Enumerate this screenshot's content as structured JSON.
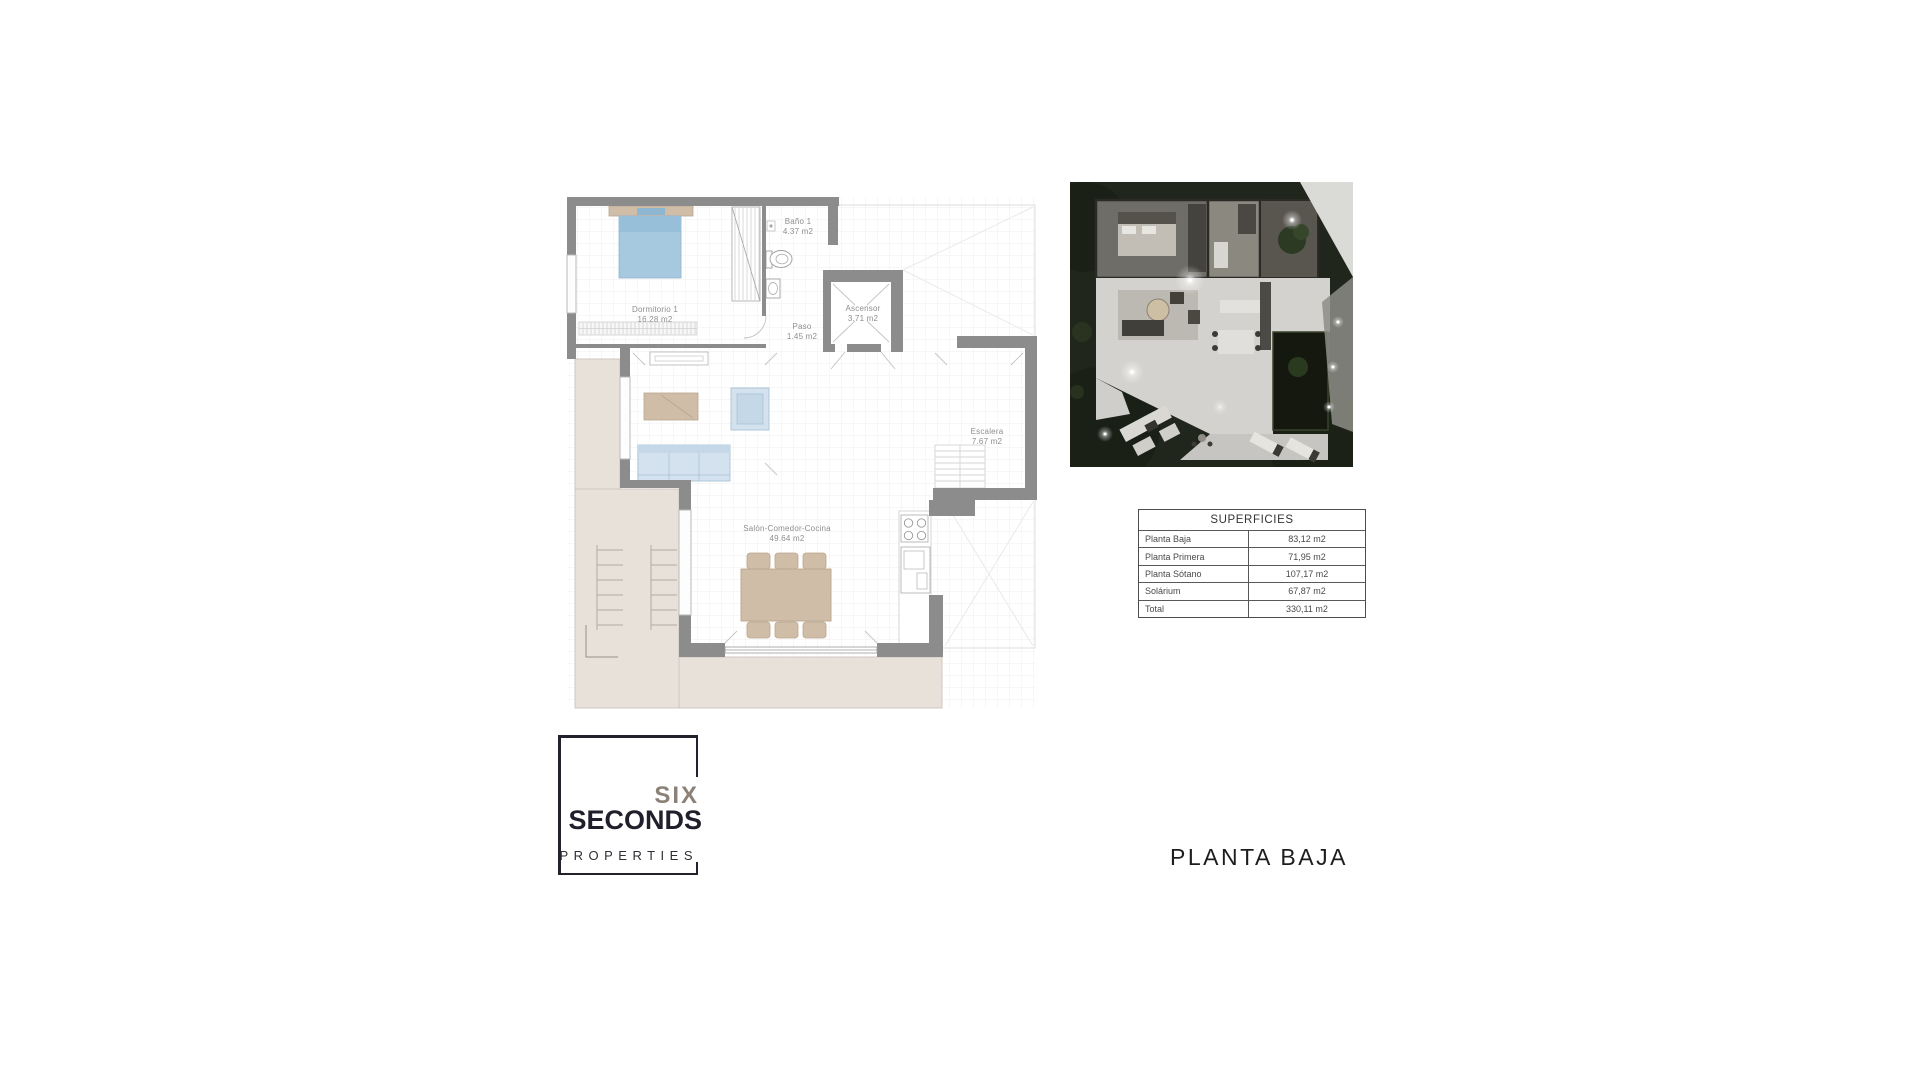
{
  "page": {
    "title": "PLANTA BAJA"
  },
  "branding": {
    "line1": "SIX",
    "line2": "SECONDS",
    "line3": "PROPERTIES"
  },
  "floor_plan": {
    "rooms": [
      {
        "name": "Dormitorio 1",
        "area": "16.28 m2"
      },
      {
        "name": "Baño 1",
        "area": "4.37 m2"
      },
      {
        "name": "Ascensor",
        "area": "3.71 m2"
      },
      {
        "name": "Paso",
        "area": "1.45 m2"
      },
      {
        "name": "Escalera",
        "area": "7.67 m2"
      },
      {
        "name": "Salón-Comedor-Cocina",
        "area": "49.64 m2"
      }
    ]
  },
  "surfaces_table": {
    "title": "SUPERFICIES",
    "rows": [
      {
        "label": "Planta Baja",
        "value": "83,12 m2"
      },
      {
        "label": "Planta Primera",
        "value": "71,95 m2"
      },
      {
        "label": "Planta Sótano",
        "value": "107,17 m2"
      },
      {
        "label": "Solárium",
        "value": "67,87 m2"
      },
      {
        "label": "Total",
        "value": "330,11 m2"
      }
    ]
  },
  "colors": {
    "wall_gray": "#8c8c8c",
    "terrace_beige": "#e8e1da",
    "furniture_tan": "#cfbda8",
    "furniture_blue": "#d3e2ee",
    "logo_taupe": "#8b8177",
    "logo_dark": "#23222c",
    "label_gray": "#8e8e8e",
    "render_grass": "#20261b"
  }
}
